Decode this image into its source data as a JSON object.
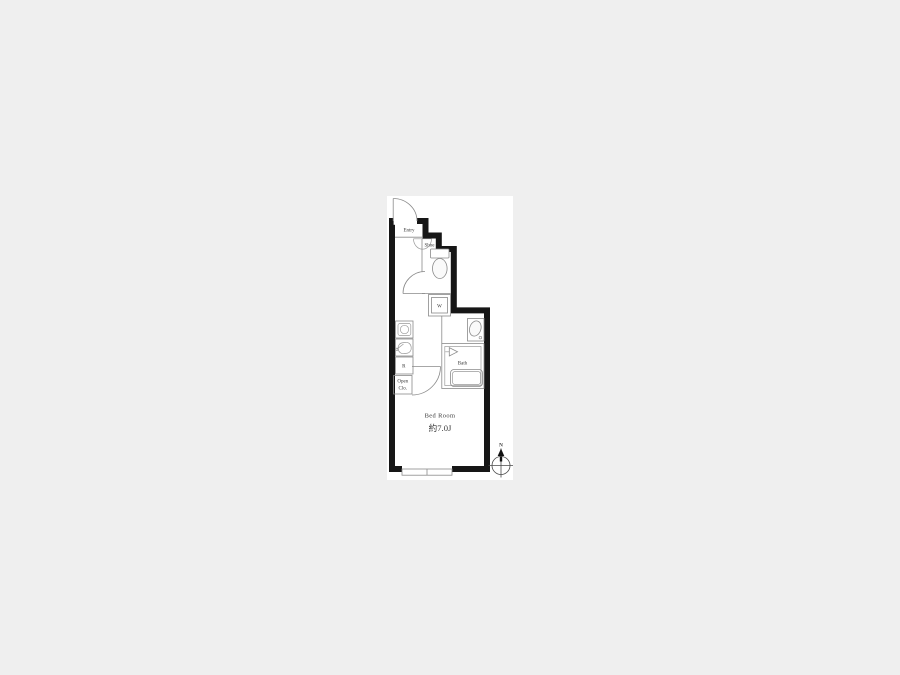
{
  "colors": {
    "background": "#efefef",
    "plan_background": "#ffffff",
    "wall": "#161616",
    "thin_line": "#8a8a8a",
    "text": "#3a3a3a"
  },
  "floorplan": {
    "labels": {
      "entry": "Entry",
      "shoe": "Shoe",
      "washer": "W",
      "refrigerator": "R",
      "open_closet_line1": "Open",
      "open_closet_line2": "Clo.",
      "bath": "Bath",
      "bedroom": "Bed Room",
      "bedroom_size": "約7.0J"
    },
    "compass": {
      "north": "N"
    }
  }
}
